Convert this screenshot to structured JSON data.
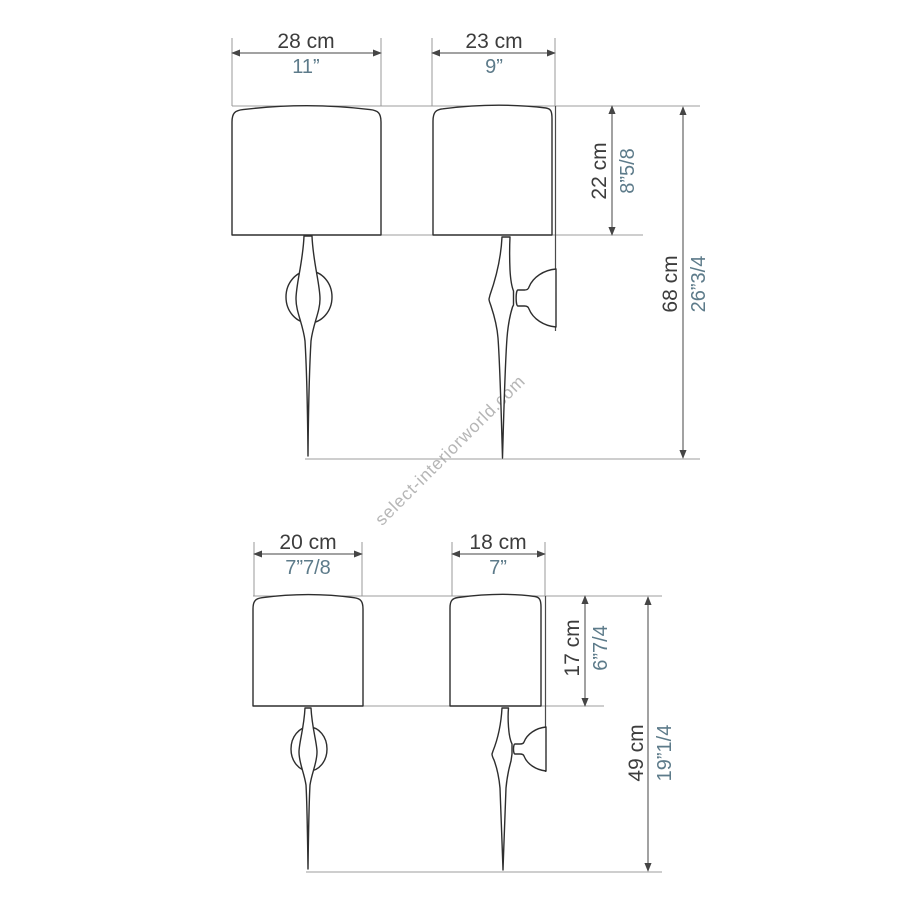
{
  "watermark": "select-interiorworld.com",
  "colors": {
    "background": "#ffffff",
    "outline": "#2e2e2e",
    "dimension_line": "#454545",
    "reference_line": "#9e9e9e",
    "cm_text": "#3d3d3d",
    "inch_text": "#5d7b8a",
    "watermark_text": "#b6b6b6"
  },
  "figures": [
    {
      "name": "large sconce",
      "front_width_cm": "28 cm",
      "front_width_in": "11”",
      "side_depth_cm": "23 cm",
      "side_depth_in": "9”",
      "shade_height_cm": "22 cm",
      "shade_height_in": "8”5/8",
      "total_height_cm": "68 cm",
      "total_height_in": "26”3/4"
    },
    {
      "name": "small sconce",
      "front_width_cm": "20 cm",
      "front_width_in": "7”7/8",
      "side_depth_cm": "18 cm",
      "side_depth_in": "7”",
      "shade_height_cm": "17 cm",
      "shade_height_in": "6”7/4",
      "total_height_cm": "49 cm",
      "total_height_in": "19”1/4"
    }
  ]
}
